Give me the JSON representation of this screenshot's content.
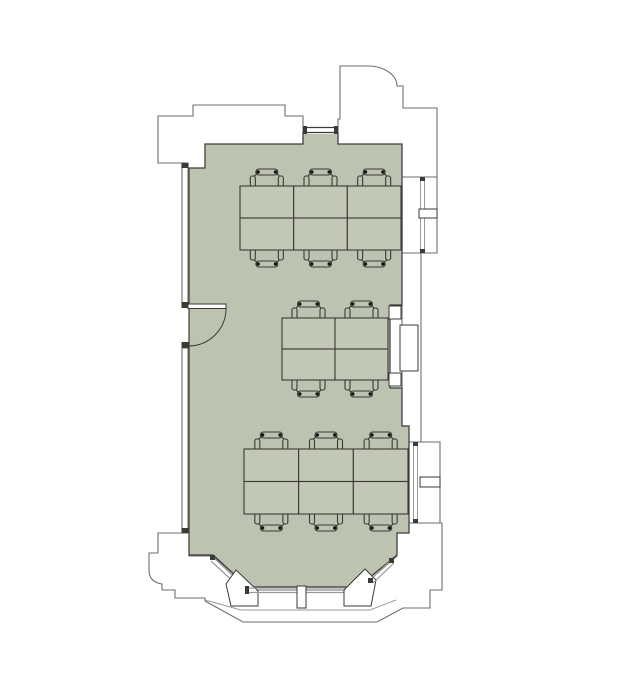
{
  "meta": {
    "type": "architectural-floor-plan",
    "description": "Top-down floor plan of a single office room with sage-green floor, three banks of desks with task chairs, a west entry door with swing arc, a north window, two east windows with mullions, and a south bay window with angled glazing panels and a central mullion",
    "room_count": 1
  },
  "palette": {
    "background": "#ffffff",
    "floor": "#bdc3b1",
    "desk_fill": "#c2c8b5",
    "wall_stroke": "#6e6e6e",
    "dark_line": "#3a3a36",
    "glazing": "#9a9a9a",
    "accent_black": "#141414"
  },
  "room": {
    "id": "office-room",
    "label": "open office room",
    "floor_color": "#bdc3b1"
  },
  "furniture": {
    "total_desks": 16,
    "total_chairs": 16,
    "clusters": [
      {
        "id": "north-cluster",
        "cols": 3,
        "rows": 2,
        "x": 240,
        "y": 186,
        "width": 161,
        "height": 64,
        "chairs_top": 3,
        "chairs_bottom": 3
      },
      {
        "id": "middle-cluster",
        "cols": 2,
        "rows": 2,
        "x": 282,
        "y": 318,
        "width": 106,
        "height": 62,
        "chairs_top": 2,
        "chairs_bottom": 2
      },
      {
        "id": "south-cluster",
        "cols": 3,
        "rows": 2,
        "x": 244,
        "y": 449,
        "width": 164,
        "height": 65,
        "chairs_top": 3,
        "chairs_bottom": 3
      }
    ]
  },
  "openings": {
    "door": {
      "id": "entry-door",
      "wall": "west",
      "swing": "inward-quarter-arc",
      "hinge_x": 188,
      "hinge_y": 308,
      "radius": 38
    },
    "windows": [
      {
        "id": "north-window",
        "wall": "north",
        "mullions": 0
      },
      {
        "id": "east-upper-window",
        "wall": "east",
        "mullions": 1
      },
      {
        "id": "east-lower-window",
        "wall": "east",
        "mullions": 1
      },
      {
        "id": "bay-left-window",
        "wall": "south-bay",
        "mullions": 0
      },
      {
        "id": "bay-center-window",
        "wall": "south-bay",
        "mullions": 1
      },
      {
        "id": "bay-right-window",
        "wall": "south-bay",
        "mullions": 0
      }
    ]
  }
}
